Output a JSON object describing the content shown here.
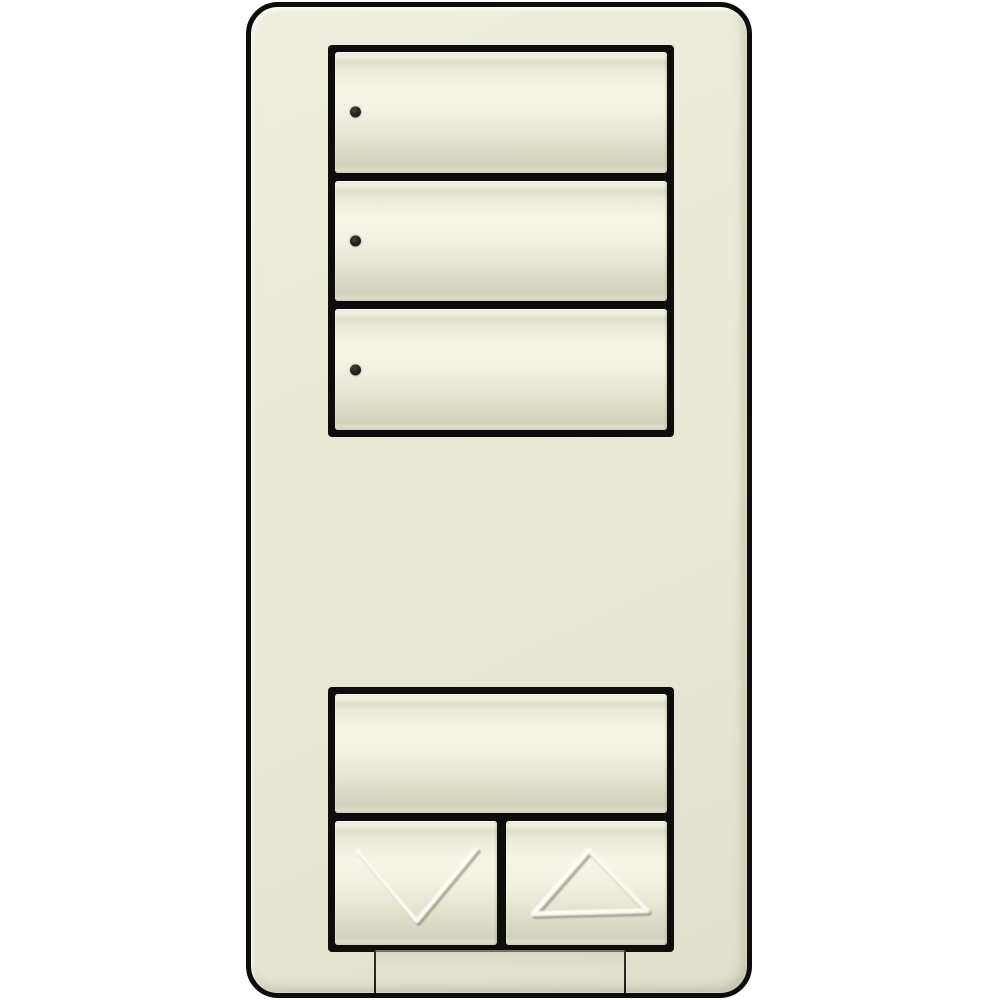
{
  "background_color": "#ffffff",
  "device": {
    "type": "wall-keypad-light-switch",
    "plate_color": "#EAE9D6",
    "button_face_color": "#F4F3E5",
    "button_shadow_color": "#D6D5C0",
    "outline_color": "#0D0D0B",
    "led_color": "#26261F",
    "top_button_group": {
      "buttons": [
        {
          "name": "keypad-button-1",
          "aria_label": "Keypad button 1",
          "has_led": true,
          "led_icon": "led-indicator"
        },
        {
          "name": "keypad-button-2",
          "aria_label": "Keypad button 2",
          "has_led": true,
          "led_icon": "led-indicator"
        },
        {
          "name": "keypad-button-3",
          "aria_label": "Keypad button 3",
          "has_led": true,
          "led_icon": "led-indicator"
        }
      ]
    },
    "bottom_button_group": {
      "large_button": {
        "name": "keypad-large-button",
        "aria_label": "Keypad large button",
        "has_led": false
      },
      "lower_button": {
        "name": "lower-button",
        "aria_label": "Lower",
        "icon": "chevron-down-icon"
      },
      "raise_button": {
        "name": "raise-button",
        "aria_label": "Raise",
        "icon": "triangle-up-icon"
      }
    },
    "bottom_tab": {
      "name": "wallplate-bottom-tab",
      "aria_label": "Wallplate removal tab"
    }
  }
}
